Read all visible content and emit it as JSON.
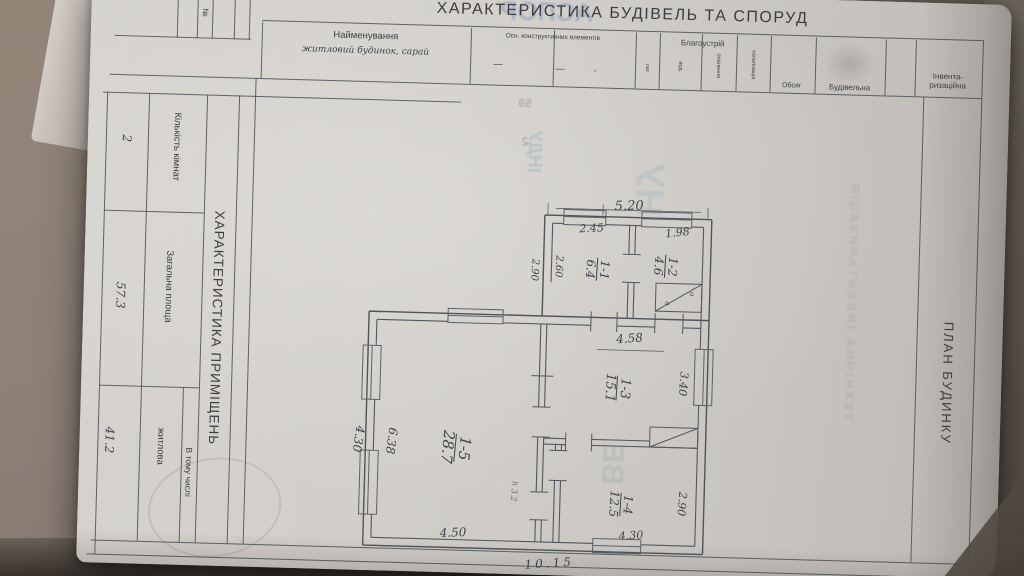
{
  "doc": {
    "title": "ХАРАКТЕРИСТИКА БУДІВЕЛЬ ТА СПОРУД",
    "header": {
      "no_col": "№",
      "name_label": "Найменування",
      "name_value": "житловий будинок, сарай",
      "constr_label": "Осн. конструктивних елементів",
      "dash1": "—",
      "dash2": "—",
      "dot": "-",
      "amen_label": "Благоустрій",
      "amen_subs": [
        "газ",
        "вод.",
        "опалення",
        "каналізація"
      ],
      "volume_label": "Обсяг",
      "build_label": "Будівельна",
      "inv_label_1": "Інвента-",
      "inv_label_2": "ризаційна"
    },
    "side": {
      "title": "ХАРАКТЕРИСТИКА ПРИМІЩЕНЬ",
      "r1_label": "Кількість кімнат",
      "r1_value": "2",
      "r2_label": "Загальна площа",
      "r2_value": "57.3",
      "group_label": "В тому числі",
      "r3_label": "житлова",
      "r3_value": "41.2"
    },
    "plan_title": "ПЛАН БУДИНКУ",
    "plan": {
      "rooms": [
        {
          "id": "1-1",
          "area": "6.4"
        },
        {
          "id": "1-2",
          "area": "4.6"
        },
        {
          "id": "1-3",
          "area": "15.1"
        },
        {
          "id": "1-4",
          "area": "12.5"
        },
        {
          "id": "1-5",
          "area": "28.7"
        }
      ],
      "dims": {
        "d520": "5.20",
        "d245": "2.45",
        "d198": "1.98",
        "d290a": "2.90",
        "d260": "2.60",
        "d458": "4.58",
        "d340": "3.40",
        "d290b": "2.90",
        "d430b": "4.30",
        "d638": "6.38",
        "d450": "4.50",
        "d430l": "4.30",
        "d1015": "10.15",
        "h_note": "h 3.2",
        "stove_o": "о",
        "stove_a": "а"
      }
    },
    "bleed": {
      "b1": "АСПОР",
      "b2": "ІНДУ",
      "b3": "НУ",
      "b4": "ВЕ",
      "b5": "59",
      "b6": "2",
      "b7": "ТЕХНІЧНА ІНВЕНТАРИЗАЦІЯ"
    }
  }
}
